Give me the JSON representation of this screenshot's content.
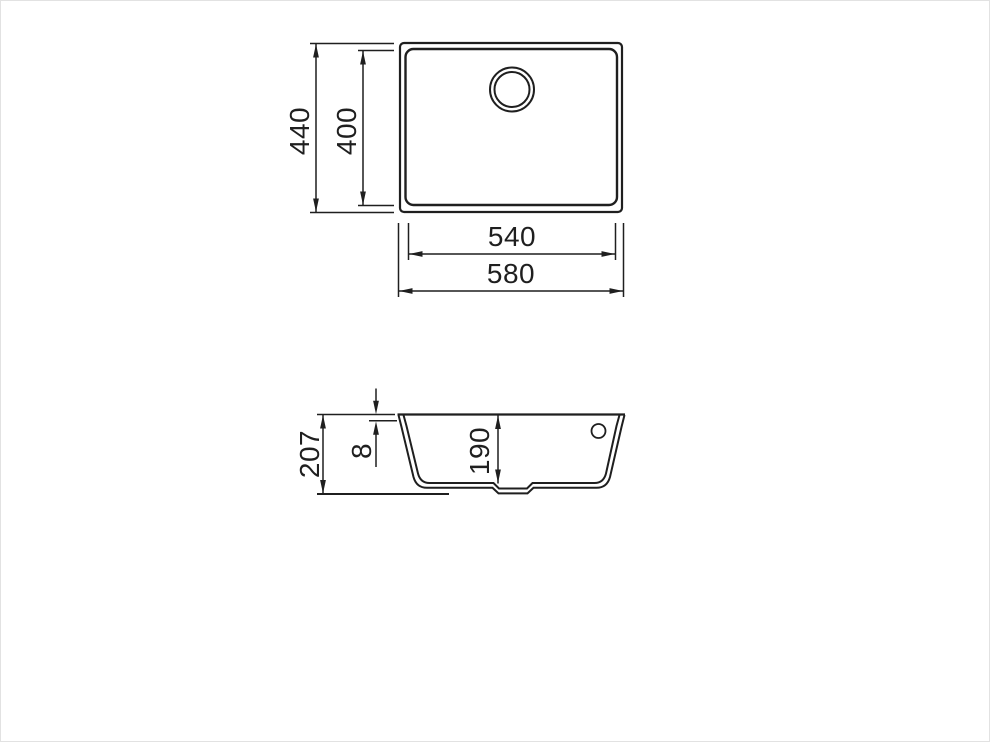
{
  "style": {
    "line_color": "#1f1f1f",
    "background": "#ffffff",
    "border_color": "#e2e2e2"
  },
  "drawing": {
    "kind": "sink technical dimension drawing",
    "views": {
      "top": {
        "name": "plan view of sink bowl with drain hole",
        "dims": {
          "outer_height": "440",
          "inner_height": "400",
          "inner_width": "540",
          "outer_width": "580"
        }
      },
      "section": {
        "name": "cross-section view of sink bowl",
        "dims": {
          "overall_depth": "207",
          "rim_thickness": "8",
          "bowl_depth": "190"
        }
      }
    }
  }
}
